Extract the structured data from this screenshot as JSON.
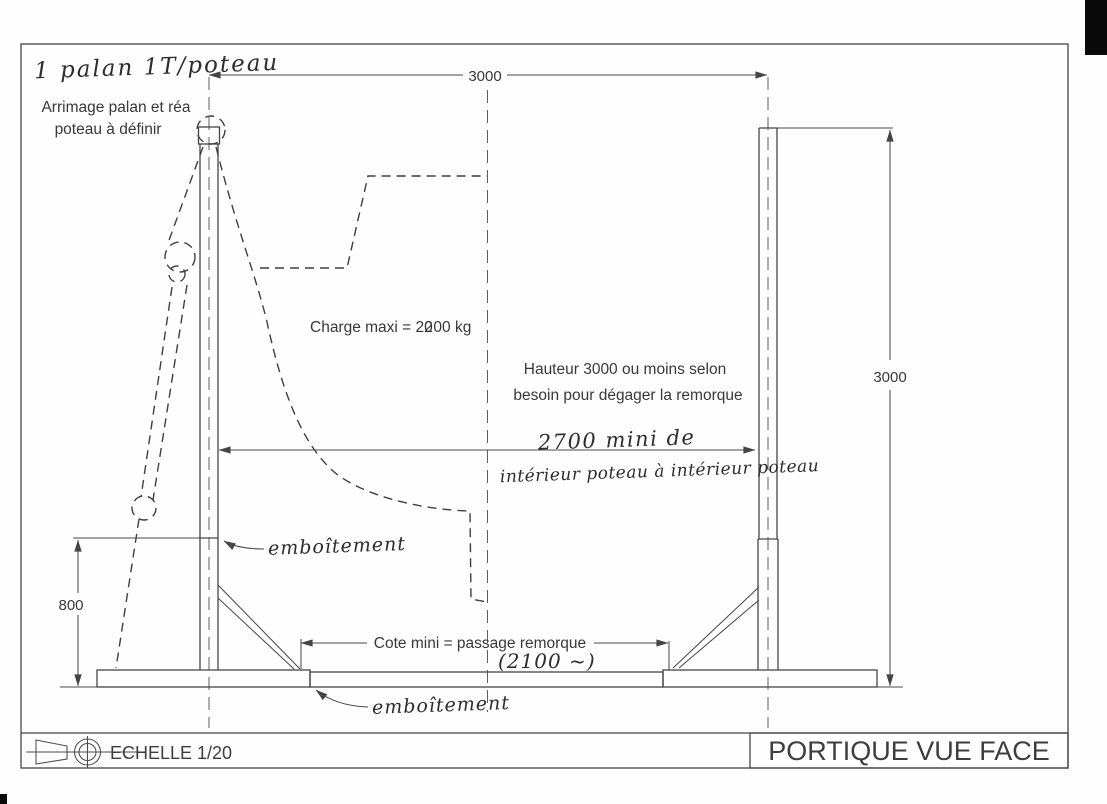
{
  "sheet": {
    "scale_label": "ECHELLE 1/20",
    "view_title": "PORTIQUE VUE FACE"
  },
  "notes": {
    "hoist_note": "1 palan 1T/poteau",
    "arrimage_line1": "Arrimage palan et réa",
    "arrimage_line2": "poteau à définir",
    "charge": {
      "prefix": "Charge maxi = 2",
      "over_digit_a": "0",
      "over_digit_b": "2",
      "suffix": "00 kg"
    },
    "hauteur_line1": "Hauteur 3000 ou moins selon",
    "hauteur_line2": "besoin pour dégager la remorque",
    "span_line1": "2700 mini de",
    "span_line2": "intérieur poteau à intérieur poteau",
    "emboitement_top": "emboîtement",
    "emboitement_bottom": "emboîtement",
    "passage_label": "Cote mini = passage remorque",
    "passage_value": "(2100 ~)"
  },
  "dimensions": {
    "width_top": "3000",
    "height_right": "3000",
    "height_left": "800"
  }
}
